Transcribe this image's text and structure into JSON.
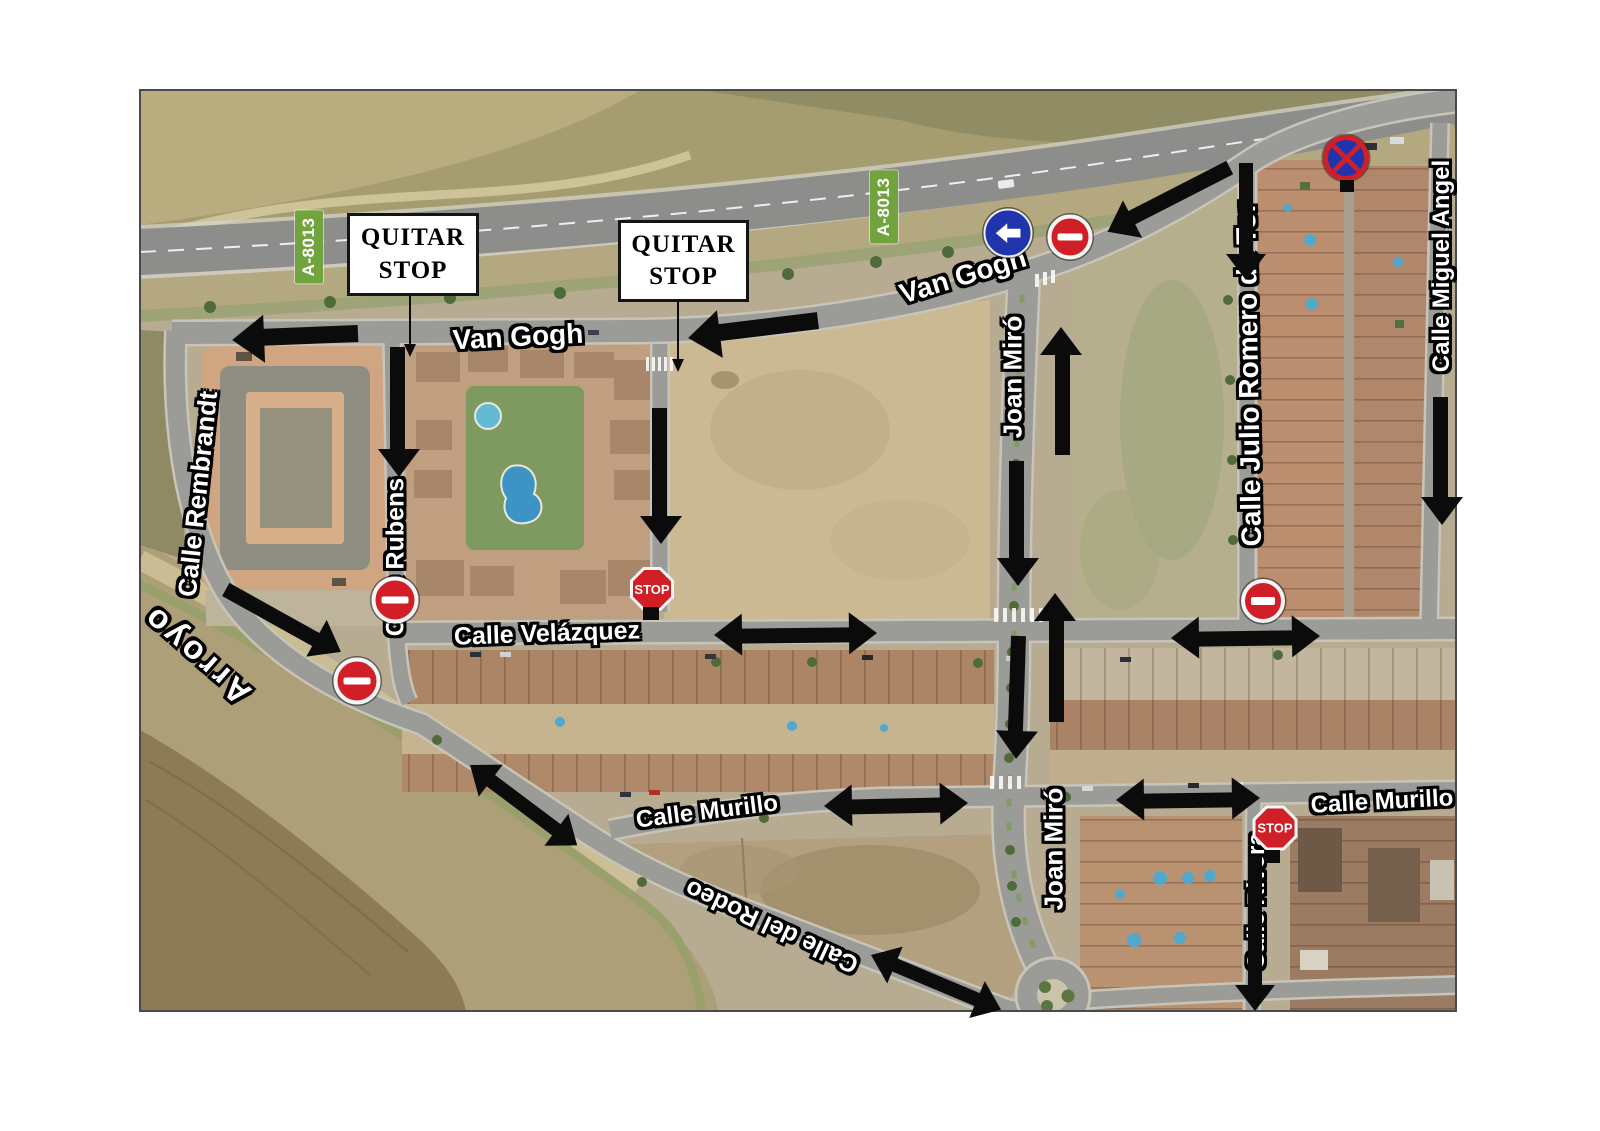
{
  "colors": {
    "arrow": "#0b0b0b",
    "sign_red": "#d01f27",
    "sign_blue": "#2034ae",
    "shield_green": "#72a43d"
  },
  "callouts": [
    {
      "line1": "QUITAR",
      "line2": "STOP",
      "x": 347,
      "y": 213,
      "w": 126,
      "h": 77
    },
    {
      "line1": "QUITAR",
      "line2": "STOP",
      "x": 618,
      "y": 220,
      "w": 125,
      "h": 76
    }
  ],
  "leaders": [
    {
      "x1": 410,
      "y1": 291,
      "x2": 410,
      "y2": 357
    },
    {
      "x1": 678,
      "y1": 297,
      "x2": 678,
      "y2": 372
    }
  ],
  "route_labels": [
    {
      "text": "A-8013",
      "x": 309,
      "y": 247,
      "rot": -90
    },
    {
      "text": "A-8013",
      "x": 884,
      "y": 207,
      "rot": -90
    }
  ],
  "street_labels": [
    {
      "text": "Van Gogh",
      "x": 518,
      "y": 337,
      "rot": -3,
      "size": 28
    },
    {
      "text": "Van Gogh",
      "x": 963,
      "y": 276,
      "rot": -17,
      "size": 28
    },
    {
      "text": "Calle Rembrandt",
      "x": 198,
      "y": 494,
      "rot": -84,
      "size": 26
    },
    {
      "text": "Calle Rubens",
      "x": 396,
      "y": 557,
      "rot": -90,
      "size": 25
    },
    {
      "text": "Calle Velázquez",
      "x": 547,
      "y": 634,
      "rot": -2,
      "size": 25
    },
    {
      "text": "Calle Murillo",
      "x": 707,
      "y": 812,
      "rot": -7,
      "size": 24
    },
    {
      "text": "Calle Murillo",
      "x": 1382,
      "y": 802,
      "rot": -3,
      "size": 24
    },
    {
      "text": "Calle del Rodeo",
      "x": 772,
      "y": 926,
      "rot": 205,
      "size": 25
    },
    {
      "text": "Joan Miró",
      "x": 1013,
      "y": 377,
      "rot": -90,
      "size": 26
    },
    {
      "text": "Joan Miró",
      "x": 1054,
      "y": 849,
      "rot": -90,
      "size": 26
    },
    {
      "text": "Calle Julio Romero de Tor",
      "x": 1249,
      "y": 374,
      "rot": -91,
      "size": 28
    },
    {
      "text": "Calle Miguel Angel",
      "x": 1442,
      "y": 266,
      "rot": -90,
      "size": 24
    },
    {
      "text": "Calle Rivera",
      "x": 1257,
      "y": 901,
      "rot": -90,
      "size": 24
    },
    {
      "text": "Arroyo",
      "x": 196,
      "y": 655,
      "rot": 221,
      "size": 33,
      "spacing": 4
    }
  ],
  "signs": [
    {
      "type": "no_entry",
      "name": "no-entry-sign",
      "x": 395,
      "y": 600,
      "d": 47
    },
    {
      "type": "no_entry",
      "name": "no-entry-sign",
      "x": 357,
      "y": 681,
      "d": 47
    },
    {
      "type": "no_entry",
      "name": "no-entry-sign",
      "x": 1070,
      "y": 237,
      "d": 45
    },
    {
      "type": "no_entry",
      "name": "no-entry-sign",
      "x": 1263,
      "y": 601,
      "d": 44
    },
    {
      "type": "stop",
      "label": "STOP",
      "name": "stop-sign",
      "x": 652,
      "y": 589,
      "d": 44
    },
    {
      "type": "stop",
      "label": "STOP",
      "name": "stop-sign",
      "x": 1275,
      "y": 828,
      "d": 45
    },
    {
      "type": "turn_left",
      "name": "turn-left-sign",
      "x": 1008,
      "y": 233,
      "d": 49
    },
    {
      "type": "no_stopping",
      "name": "no-stopping-sign",
      "x": 1346,
      "y": 158,
      "d": 46
    },
    {
      "type": "pole",
      "name": "sign-pole",
      "x": 651,
      "y": 607,
      "w": 16,
      "h": 13
    },
    {
      "type": "pole",
      "name": "sign-pole",
      "x": 1347,
      "y": 180,
      "w": 14,
      "h": 12
    },
    {
      "type": "pole",
      "name": "sign-pole",
      "x": 1272,
      "y": 850,
      "w": 16,
      "h": 13
    }
  ],
  "arrows": [
    {
      "x1": 358,
      "y1": 334,
      "x2": 232,
      "y2": 339,
      "w": 17
    },
    {
      "x1": 818,
      "y1": 321,
      "x2": 688,
      "y2": 337,
      "w": 17
    },
    {
      "x1": 398,
      "y1": 347,
      "x2": 398,
      "y2": 477,
      "w": 15
    },
    {
      "x1": 660,
      "y1": 408,
      "x2": 660,
      "y2": 544,
      "w": 15
    },
    {
      "x1": 1230,
      "y1": 168,
      "x2": 1107,
      "y2": 231,
      "w": 15
    },
    {
      "x1": 1246,
      "y1": 163,
      "x2": 1246,
      "y2": 281,
      "w": 14
    },
    {
      "x1": 1441,
      "y1": 397,
      "x2": 1441,
      "y2": 525,
      "w": 15
    },
    {
      "x1": 1062,
      "y1": 455,
      "x2": 1062,
      "y2": 327,
      "w": 15
    },
    {
      "x1": 1017,
      "y1": 461,
      "x2": 1017,
      "y2": 586,
      "w": 15
    },
    {
      "x1": 1056,
      "y1": 722,
      "x2": 1056,
      "y2": 593,
      "w": 15
    },
    {
      "x1": 1019,
      "y1": 636,
      "x2": 1015,
      "y2": 759,
      "w": 15
    },
    {
      "x1": 714,
      "y1": 636,
      "x2": 877,
      "y2": 634,
      "w": 15,
      "double": true
    },
    {
      "x1": 1171,
      "y1": 639,
      "x2": 1320,
      "y2": 637,
      "w": 15,
      "double": true
    },
    {
      "x1": 226,
      "y1": 589,
      "x2": 341,
      "y2": 653,
      "w": 15
    },
    {
      "x1": 470,
      "y1": 765,
      "x2": 578,
      "y2": 846,
      "w": 14,
      "double": true
    },
    {
      "x1": 824,
      "y1": 807,
      "x2": 968,
      "y2": 804,
      "w": 15,
      "double": true
    },
    {
      "x1": 1116,
      "y1": 801,
      "x2": 1260,
      "y2": 799,
      "w": 15,
      "double": true
    },
    {
      "x1": 1255,
      "y1": 856,
      "x2": 1255,
      "y2": 1012,
      "w": 14
    },
    {
      "x1": 871,
      "y1": 955,
      "x2": 1002,
      "y2": 1010,
      "w": 14,
      "double": true
    }
  ]
}
